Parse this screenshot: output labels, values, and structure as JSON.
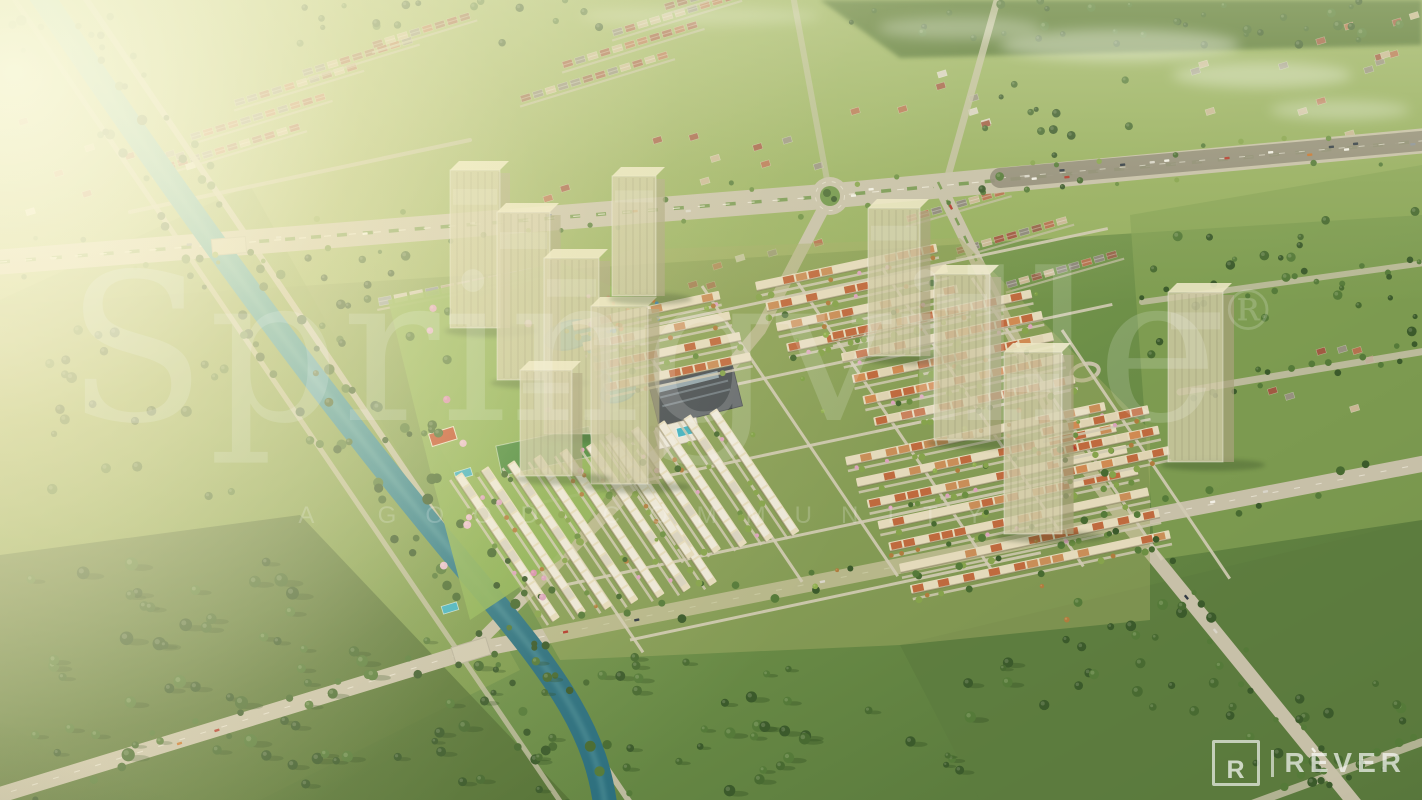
{
  "watermark": {
    "brand": "Springville",
    "registered_mark": "®",
    "tagline": "A GOOD COMMUNITY"
  },
  "logo": {
    "monogram": "R",
    "name": "REVER"
  },
  "scene": {
    "type": "aerial-3d-render",
    "lighting": "golden-hour sun glow from upper left with mist at top",
    "colors": {
      "grass-light": "#9db464",
      "grass-mid": "#7d9b4d",
      "grass-dark": "#546f35",
      "tree-dark": "#3b5a2b",
      "tree-mid": "#486a31",
      "tree-light": "#557a39",
      "park-green": "#8fb257",
      "road": "#c7c0a8",
      "road-dark": "#8f8a76",
      "river": "#3f99a1",
      "river-deep": "#2c6f7e",
      "tower-face": "#d1cba6",
      "tower-top": "#ece7c4",
      "roof-cream": "#e4dabb",
      "roof-orange": "#bf6a3e",
      "roof-terracotta": "#a05a42",
      "clubhouse-roof": "#4a5054",
      "pool": "#3fb0c0",
      "court": "#c3512e",
      "blossom": "#dba3bc",
      "median-green": "#6f9448"
    },
    "landmarks": [
      {
        "name": "canal",
        "label": "tree-lined turquoise canal from top left to bottom centre"
      },
      {
        "name": "main-boulevard",
        "label": "wide boulevard with roundabout across the top"
      },
      {
        "name": "roundabout",
        "label": "landscaped traffic circle"
      },
      {
        "name": "ghost-towers",
        "label": "translucent future high-rise masses in two groups"
      },
      {
        "name": "townhouse-grid",
        "label": "rows of cream and terracotta townhouses"
      },
      {
        "name": "central-park",
        "label": "park with ponds, playground, sports court and pools"
      },
      {
        "name": "clubhouse",
        "label": "dark-roofed clubhouse complex"
      },
      {
        "name": "suburbs",
        "label": "low-density housing and green fields around the site"
      }
    ]
  }
}
